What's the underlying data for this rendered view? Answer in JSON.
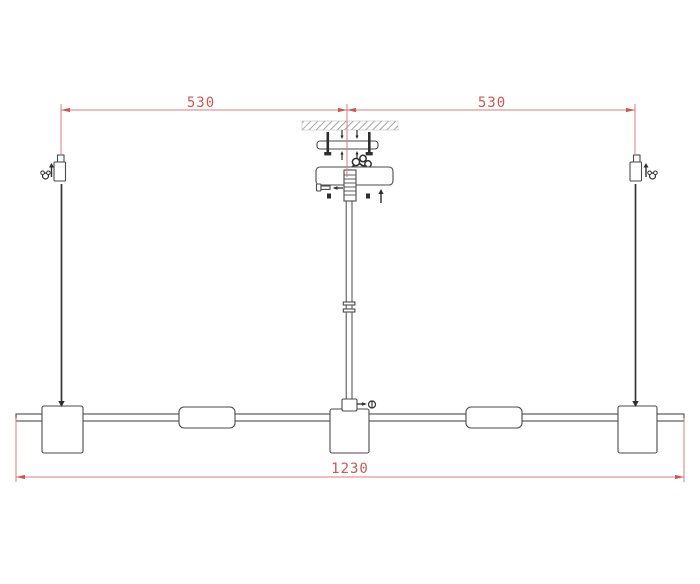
{
  "page": {
    "type": "technical-line-drawing",
    "subject": "linear pendant lamp installation / dimension diagram",
    "background": "#ffffff"
  },
  "colors": {
    "dimension_red": "#d0534e",
    "dimension_line_red": "#de7d78",
    "drawing_line": "#4a4a4a",
    "solid_parts": "#2e2e2e"
  },
  "dimensions": {
    "top_left_span": "530",
    "top_right_span": "530",
    "overall_width": "1230"
  }
}
